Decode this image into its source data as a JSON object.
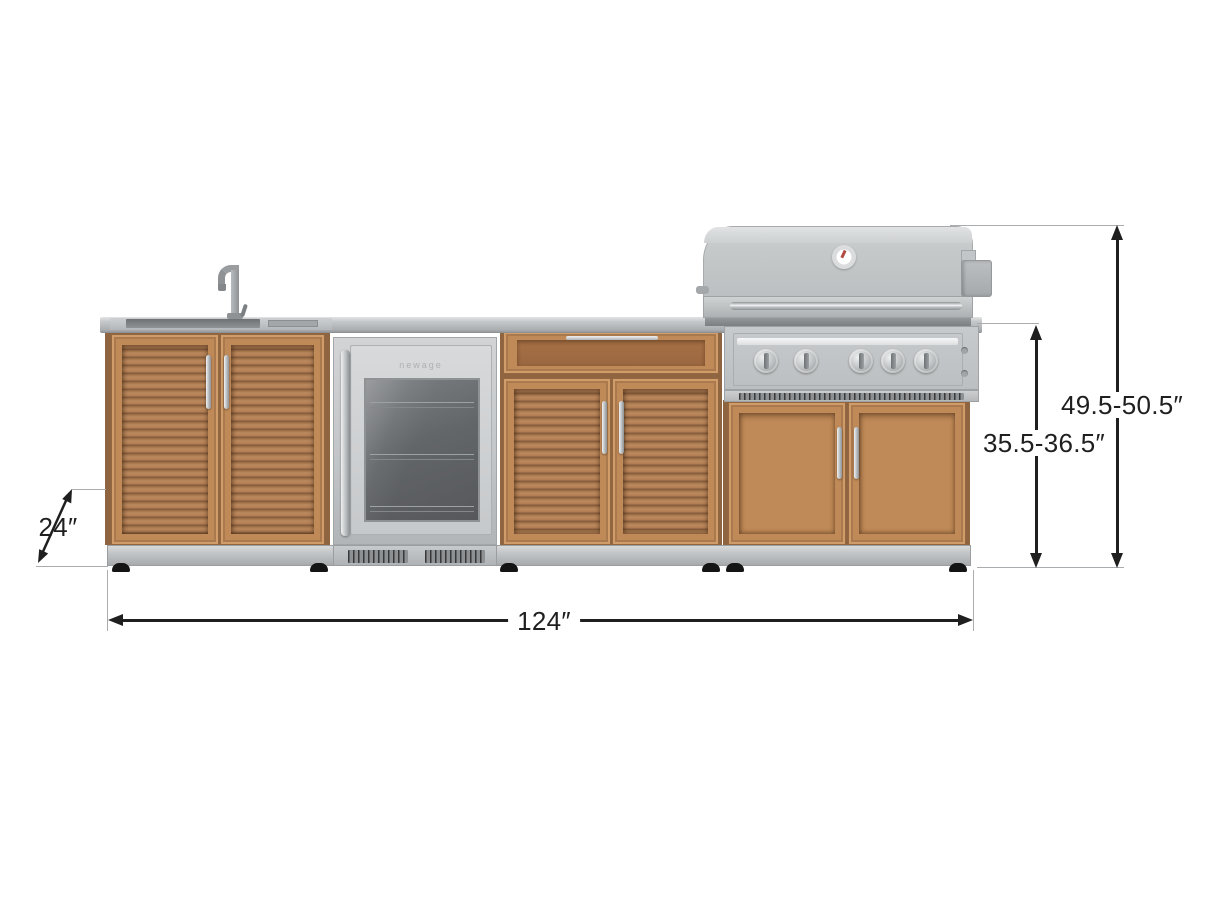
{
  "diagram": {
    "title": "Outdoor kitchen cabinet set dimension drawing",
    "product": "Stainless steel and grove wood outdoor kitchen: sink cabinet, under-counter glass-door fridge, drawer-and-door cabinet, and built-in 5-burner grill cabinet",
    "dimensions": {
      "depth": "24″",
      "width": "124″",
      "counter_height_range": "35.5-36.5″",
      "overall_height_range": "49.5-50.5″"
    },
    "fridge": {
      "brand_label": "newage"
    },
    "colors": {
      "wood": "#b5815a",
      "wood_slat_dark": "#7e583a",
      "wood_frame": "#c08a58",
      "stainless_light": "#d0d3d5",
      "stainless": "#c0c3c5",
      "stainless_dark": "#9ea1a3",
      "dimension_text": "#1f1f1f",
      "extension_line": "#aaadb0",
      "background": "#ffffff"
    }
  }
}
